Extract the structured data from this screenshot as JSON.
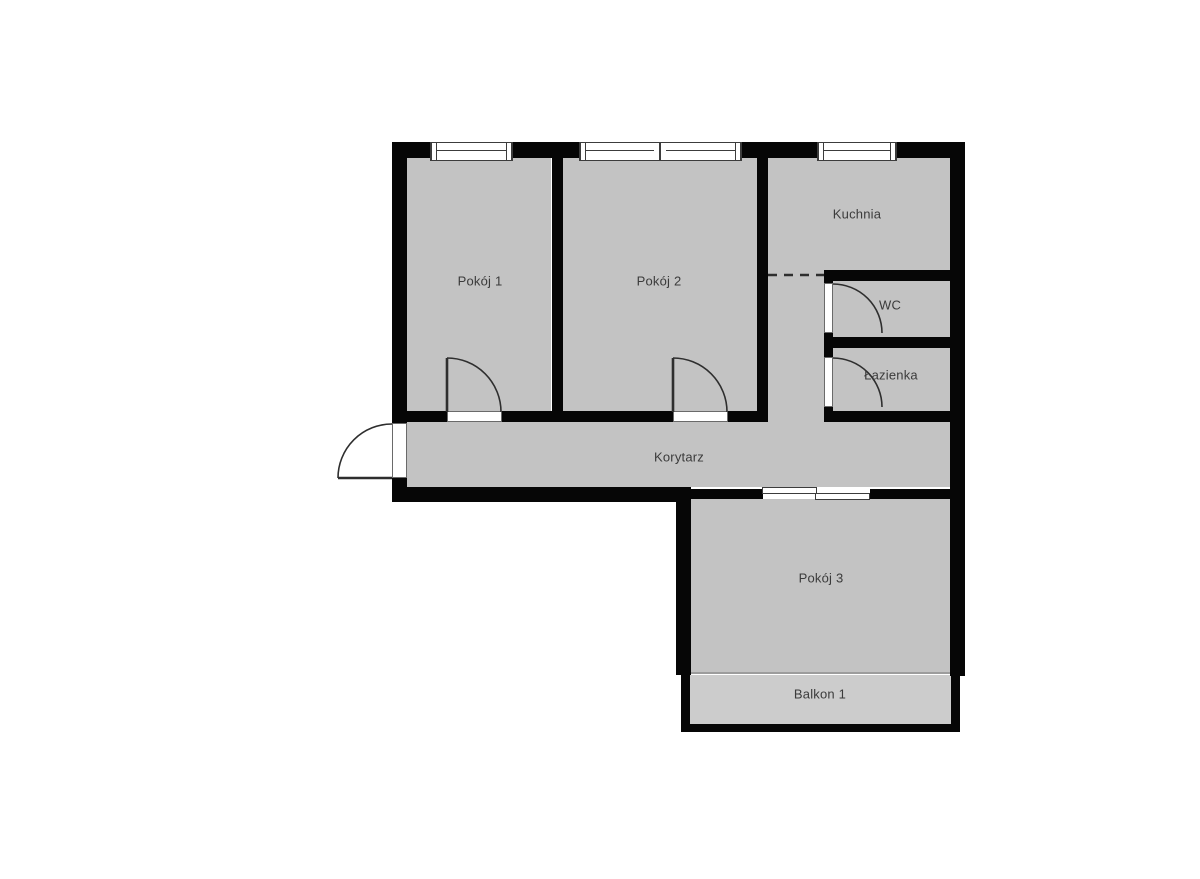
{
  "colors": {
    "background": "#ffffff",
    "wall": "#060606",
    "room-fill": "#c3c3c3",
    "balcony-fill": "#cccccc",
    "label-text": "#3b3b3b",
    "frame-stroke": "#3c3c3c",
    "sill-stroke": "#6a6a6a",
    "door-stroke": "#2e2e2e",
    "threshold": "#9c9c9c"
  },
  "rooms": [
    {
      "id": "pokoj-1",
      "label": "Pokój 1"
    },
    {
      "id": "pokoj-2",
      "label": "Pokój 2"
    },
    {
      "id": "kuchnia",
      "label": "Kuchnia"
    },
    {
      "id": "wc",
      "label": "WC"
    },
    {
      "id": "lazienka",
      "label": "Łazienka"
    },
    {
      "id": "korytarz",
      "label": "Korytarz"
    },
    {
      "id": "pokoj-3",
      "label": "Pokój 3"
    },
    {
      "id": "balkon-1",
      "label": "Balkon 1"
    }
  ]
}
